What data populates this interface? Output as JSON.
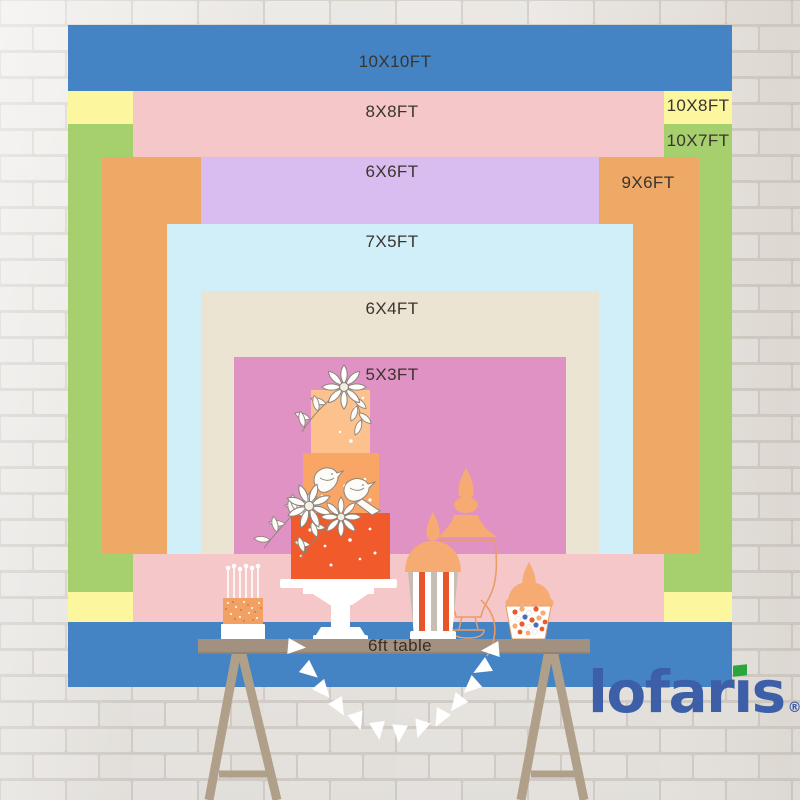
{
  "backdrops": [
    {
      "id": "10x10ft",
      "label": "10X10FT",
      "width_ft": 10,
      "height_ft": 10,
      "color": "#4484c5",
      "x": 68,
      "y": 25,
      "w": 664,
      "h": 662,
      "label_x": 395,
      "label_y": 62
    },
    {
      "id": "10x8ft",
      "label": "10X8FT",
      "width_ft": 10,
      "height_ft": 8,
      "color": "#fcf69e",
      "x": 68,
      "y": 91,
      "w": 664,
      "h": 531,
      "label_x": 698,
      "label_y": 106
    },
    {
      "id": "10x7ft",
      "label": "10X7FT",
      "width_ft": 10,
      "height_ft": 7,
      "color": "#a6d06e",
      "x": 68,
      "y": 124,
      "w": 664,
      "h": 468,
      "label_x": 698,
      "label_y": 141
    },
    {
      "id": "8x8ft",
      "label": "8X8FT",
      "width_ft": 8,
      "height_ft": 8,
      "color": "#f5c7c8",
      "x": 133,
      "y": 91,
      "w": 531,
      "h": 531,
      "label_x": 392,
      "label_y": 112
    },
    {
      "id": "9x6ft",
      "label": "9X6FT",
      "width_ft": 9,
      "height_ft": 6,
      "color": "#efa966",
      "x": 102,
      "y": 157,
      "w": 597,
      "h": 397,
      "label_x": 648,
      "label_y": 183
    },
    {
      "id": "6x6ft",
      "label": "6X6FT",
      "width_ft": 6,
      "height_ft": 6,
      "color": "#dabdf0",
      "x": 201,
      "y": 157,
      "w": 398,
      "h": 397,
      "label_x": 392,
      "label_y": 172
    },
    {
      "id": "7x5ft",
      "label": "7X5FT",
      "width_ft": 7,
      "height_ft": 5,
      "color": "#d0eff8",
      "x": 167,
      "y": 224,
      "w": 466,
      "h": 330,
      "label_x": 392,
      "label_y": 242
    },
    {
      "id": "6x4ft",
      "label": "6X4FT",
      "width_ft": 6,
      "height_ft": 4,
      "color": "#ebe4d2",
      "x": 201,
      "y": 291,
      "w": 398,
      "h": 263,
      "label_x": 392,
      "label_y": 309
    },
    {
      "id": "5x3ft",
      "label": "5X3FT",
      "width_ft": 5,
      "height_ft": 3,
      "color": "#df92c3",
      "x": 234,
      "y": 357,
      "w": 332,
      "h": 197,
      "label_x": 392,
      "label_y": 375
    }
  ],
  "table": {
    "label": "6ft table",
    "top_color": "#a29180",
    "leg_color": "#b0a089"
  },
  "logo": {
    "text": "lofaris",
    "registered_mark": "®",
    "color": "#3d5fa8",
    "flag_color": "#2aa63c"
  },
  "colors": {
    "wall_brick": "#f3f1ee",
    "wall_mortar": "#dbd7d2",
    "label_text": "#3a342e",
    "cake_tiers": [
      "#fcc18d",
      "#f9a566",
      "#f15b2c"
    ],
    "jar_peach": "#f6ab72",
    "accent_orange": "#ea5b2c"
  }
}
